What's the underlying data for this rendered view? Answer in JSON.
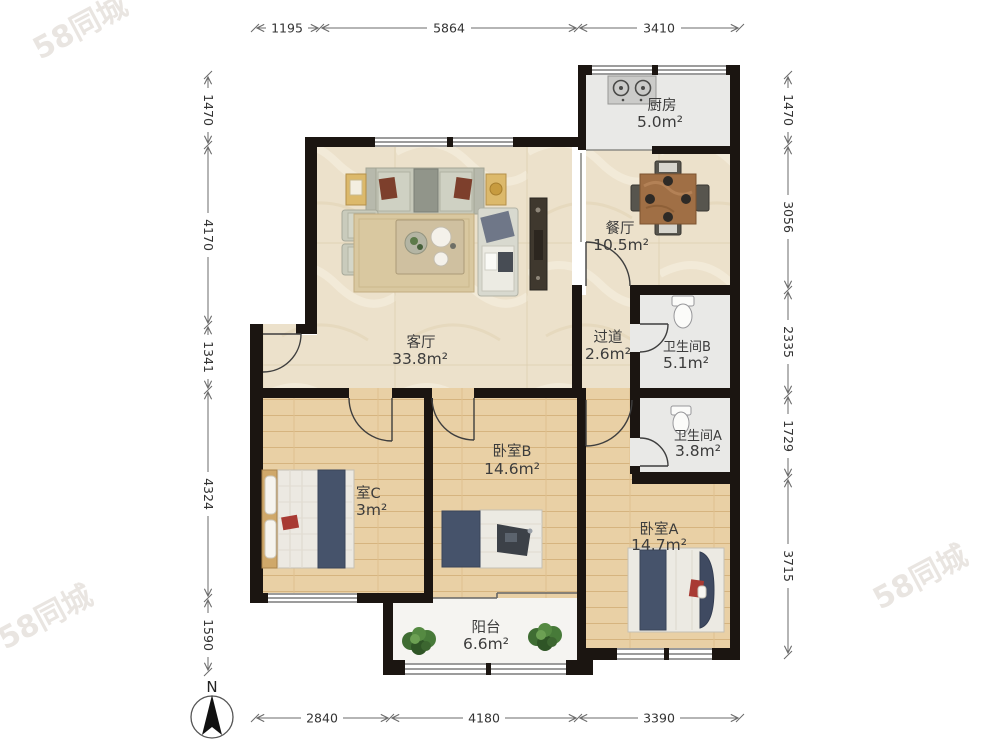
{
  "meta": {
    "north_label": "N"
  },
  "watermark": {
    "text": "58同城"
  },
  "rooms": [
    {
      "id": "kitchen",
      "name": "厨房",
      "area": "5.0m²"
    },
    {
      "id": "dining",
      "name": "餐厅",
      "area": "10.5m²"
    },
    {
      "id": "living",
      "name": "客厅",
      "area": "33.8m²"
    },
    {
      "id": "hallway",
      "name": "过道",
      "area": "2.6m²"
    },
    {
      "id": "bathroom-b",
      "name": "卫生间B",
      "area": "5.1m²"
    },
    {
      "id": "bathroom-a",
      "name": "卫生间A",
      "area": "3.8m²"
    },
    {
      "id": "bedroom-b",
      "name": "卧室B",
      "area": "14.6m²"
    },
    {
      "id": "bedroom-c",
      "name": "室C",
      "area": "3m²"
    },
    {
      "id": "bedroom-a",
      "name": "卧室A",
      "area": "14.7m²"
    },
    {
      "id": "balcony",
      "name": "阳台",
      "area": "6.6m²"
    }
  ],
  "dimensions": {
    "top": [
      "1195",
      "5864",
      "3410"
    ],
    "bottom": [
      "2840",
      "4180",
      "3390"
    ],
    "left": [
      "1470",
      "4170",
      "1341",
      "4324",
      "1590"
    ],
    "right": [
      "1470",
      "3056",
      "2335",
      "1729",
      "3715"
    ]
  },
  "colors": {
    "wall": "#1b1511",
    "marble_floor": "#ece1cb",
    "wood_floor": "#e9d0a5",
    "tile_floor": "#e9e9e7",
    "balcony_floor": "#f5f4f1",
    "bed_blanket_navy": "#46536b",
    "accent_red": "#a83a33",
    "plant_green": "#3f6d33",
    "dim_line": "#6b6b6b"
  }
}
